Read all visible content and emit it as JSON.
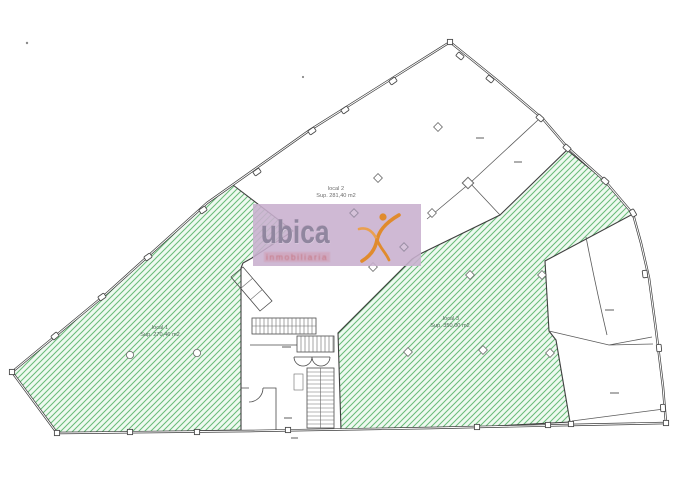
{
  "watermark": {
    "brand": "ubica",
    "tagline": "inmobiliaria",
    "bg_color": "#c8afce",
    "brand_color": "#90869f",
    "tagline_color": "#c4707c",
    "figure_color": "#e08b2d"
  },
  "locals": {
    "local1": {
      "label": "local 1",
      "sup": "Sup. 270,46 m2"
    },
    "local2": {
      "label": "local 2",
      "sup": "Sup. 281,40 m2"
    },
    "local3": {
      "label": "local 3",
      "sup": "Sup. 350,00 m2"
    }
  },
  "colors": {
    "hatch_line": "#68bb78",
    "hatch_bg": "#eef9f0",
    "wall": "#3c3c3c",
    "interior_line": "#5a5a5a"
  }
}
